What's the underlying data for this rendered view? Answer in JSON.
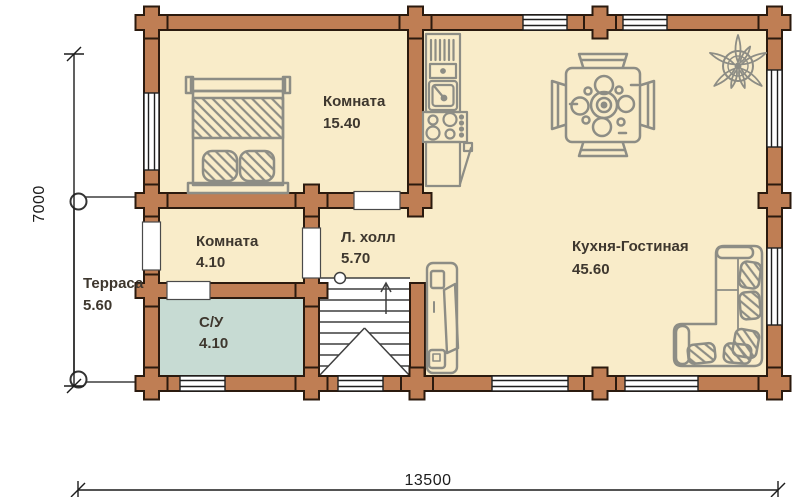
{
  "plan": {
    "title": "log-house-floor-plan",
    "colors": {
      "wall": "#bf7e54",
      "wall_outline": "#2b1a0e",
      "floor": "#f9ecc9",
      "bathroom": "#c7dbd3",
      "terrace": "#ffffff",
      "furniture": "#8d8d85",
      "label": "#3e372e",
      "dimension": "#1c1c1c"
    },
    "rooms": [
      {
        "name": "Комната",
        "area": "15.40"
      },
      {
        "name": "Комната",
        "area": "4.10"
      },
      {
        "name": "Л. холл",
        "area": "5.70"
      },
      {
        "name": "Кухня-Гостиная",
        "area": "45.60"
      },
      {
        "name": "Терраса",
        "area": "5.60"
      },
      {
        "name": "С/У",
        "area": "4.10"
      }
    ],
    "dimensions": {
      "bottom": "13500",
      "left": "7000"
    },
    "furniture_icons": [
      "double-bed",
      "kitchen-block",
      "dining-table",
      "compass-rose",
      "corner-sofa",
      "tv-stand",
      "staircase"
    ]
  }
}
